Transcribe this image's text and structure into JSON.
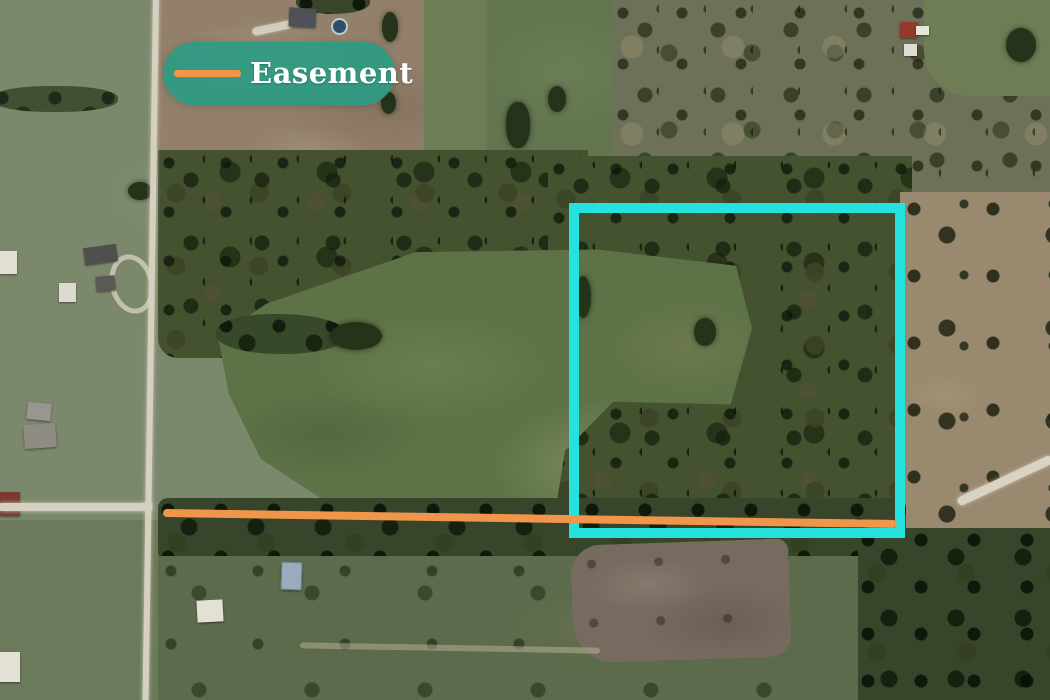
{
  "map": {
    "view": "satellite-aerial",
    "legend": {
      "label": "Easement",
      "swatch_color": "#F0964A",
      "pill_color": "#2E9B84",
      "pill_opacity": 0.92,
      "text_color": "#FFFFFF"
    },
    "annotations": {
      "easement_line": {
        "label": "Easement",
        "color": "#F0964A",
        "thickness": 8,
        "from": {
          "x": 163,
          "y": 513
        },
        "to": {
          "x": 897,
          "y": 524
        }
      },
      "parcel_boundary": {
        "shape": "rectangle",
        "color": "#26E2DF",
        "stroke_width": 10,
        "x": 569,
        "y": 203,
        "width": 336,
        "height": 335
      }
    }
  }
}
